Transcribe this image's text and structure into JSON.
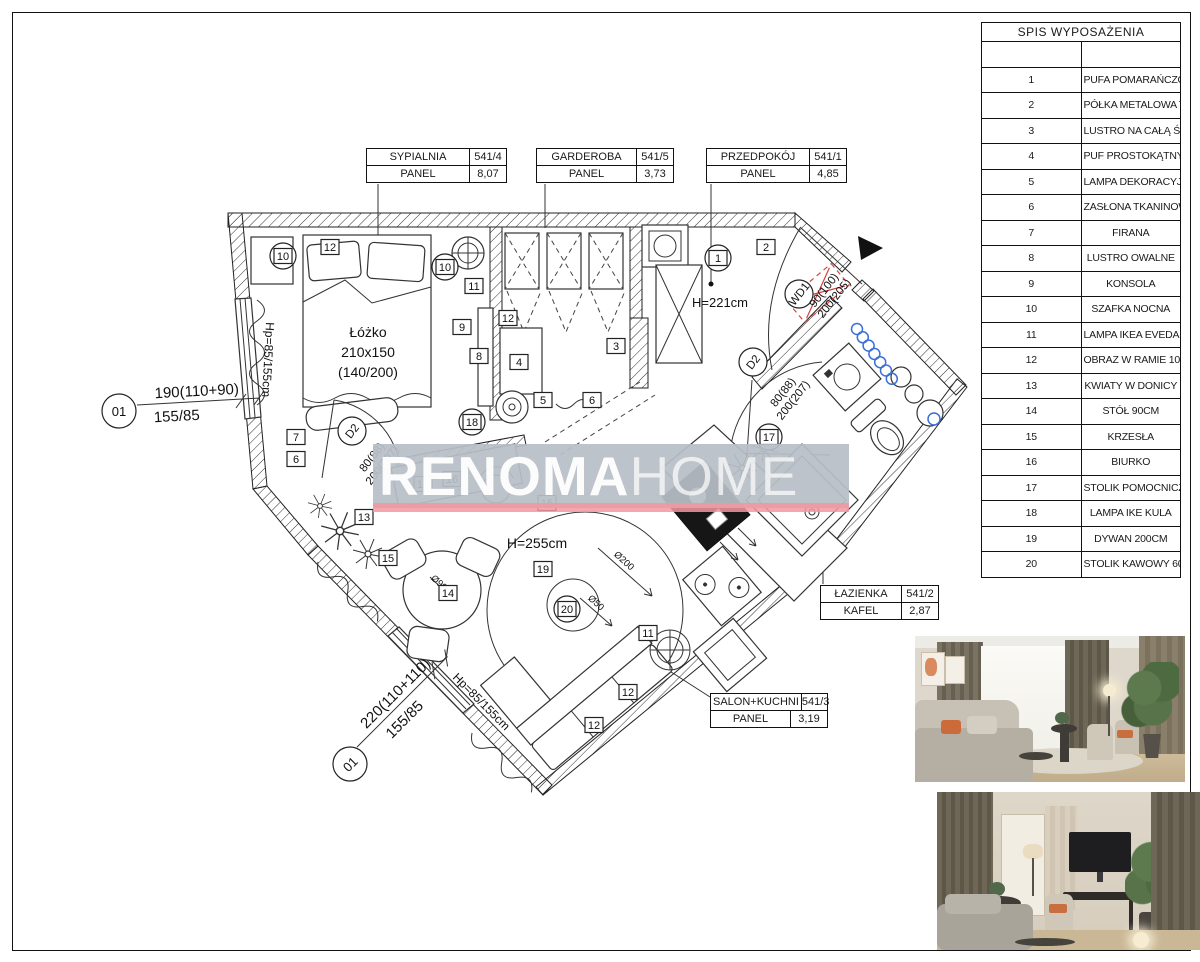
{
  "legend": {
    "title": "SPIS WYPOSAŻENIA",
    "items": [
      {
        "n": "1",
        "label": "PUFA POMARAŃCZOWA 40 CM"
      },
      {
        "n": "2",
        "label": "PÓŁKA METALOWA TRÓJĄTNA"
      },
      {
        "n": "3",
        "label": "LUSTRO NA CAŁĄ ŚCIANĘ"
      },
      {
        "n": "4",
        "label": "PUF PROSTOKĄTNY"
      },
      {
        "n": "5",
        "label": "LAMPA DEKORACYJNA IKEA ....."
      },
      {
        "n": "6",
        "label": "ZASŁONA TKANINOWA"
      },
      {
        "n": "7",
        "label": "FIRANA"
      },
      {
        "n": "8",
        "label": "LUSTRO OWALNE"
      },
      {
        "n": "9",
        "label": "KONSOLA"
      },
      {
        "n": "10",
        "label": "SZAFKA NOCNA"
      },
      {
        "n": "11",
        "label": "LAMPA IKEA EVEDAL"
      },
      {
        "n": "12",
        "label": "OBRAZ W RAMIE 100X70"
      },
      {
        "n": "13",
        "label": "KWIATY W DONICY"
      },
      {
        "n": "14",
        "label": "STÓŁ 90CM"
      },
      {
        "n": "15",
        "label": "KRZESŁA"
      },
      {
        "n": "16",
        "label": "BIURKO"
      },
      {
        "n": "17",
        "label": "STOLIK POMOCNICZY"
      },
      {
        "n": "18",
        "label": "LAMPA IKE KULA"
      },
      {
        "n": "19",
        "label": "DYWAN 200CM"
      },
      {
        "n": "20",
        "label": "STOLIK KAWOWY 60"
      }
    ]
  },
  "rooms": [
    {
      "name": "SYPIALNIA",
      "num": "541/4",
      "floor": "PANEL",
      "area": "8,07"
    },
    {
      "name": "GARDEROBA",
      "num": "541/5",
      "floor": "PANEL",
      "area": "3,73"
    },
    {
      "name": "PRZEDPOKÓJ",
      "num": "541/1",
      "floor": "PANEL",
      "area": "4,85"
    },
    {
      "name": "ŁAZIENKA",
      "num": "541/2",
      "floor": "KAFEL",
      "area": "2,87"
    },
    {
      "name": "SALON+KUCHNI",
      "num": "541/3",
      "floor": "PANEL",
      "area": "3,19"
    }
  ],
  "plan": {
    "bed": {
      "l1": "Łóżko",
      "l2": "210x150",
      "l3": "(140/200)"
    },
    "heights": {
      "hall": "H=221cm",
      "salon": "H=255cm",
      "parapet": "Hp=85/155cm"
    },
    "dims": {
      "win1": {
        "tag": "01",
        "top": "190(110+90)",
        "bottom": "155/85"
      },
      "win2": {
        "tag": "01",
        "top": "220(110+110)",
        "bottom": "155/85"
      },
      "door_int": {
        "tag": "D2",
        "w": "80(88)",
        "h": "200(207)"
      },
      "door_entry": {
        "tag": "WD1",
        "w": "90(100)",
        "h": "200(205)"
      }
    },
    "diameters": {
      "rug": "Ø200",
      "inner": "Ø50",
      "table": "Ø90"
    },
    "markers": [
      {
        "x": 283,
        "y": 256,
        "t": "10",
        "s": "cs"
      },
      {
        "x": 330,
        "y": 247,
        "t": "12",
        "s": "sq"
      },
      {
        "x": 445,
        "y": 267,
        "t": "10",
        "s": "cs"
      },
      {
        "x": 474,
        "y": 286,
        "t": "11",
        "s": "sq"
      },
      {
        "x": 462,
        "y": 327,
        "t": "9",
        "s": "sq"
      },
      {
        "x": 479,
        "y": 356,
        "t": "8",
        "s": "sq"
      },
      {
        "x": 296,
        "y": 437,
        "t": "7",
        "s": "sq"
      },
      {
        "x": 296,
        "y": 459,
        "t": "6",
        "s": "sq"
      },
      {
        "x": 508,
        "y": 318,
        "t": "12",
        "s": "sq"
      },
      {
        "x": 519,
        "y": 362,
        "t": "4",
        "s": "sq"
      },
      {
        "x": 543,
        "y": 400,
        "t": "5",
        "s": "sq"
      },
      {
        "x": 592,
        "y": 400,
        "t": "6",
        "s": "sq"
      },
      {
        "x": 616,
        "y": 346,
        "t": "3",
        "s": "sq"
      },
      {
        "x": 718,
        "y": 258,
        "t": "1",
        "s": "cs"
      },
      {
        "x": 766,
        "y": 247,
        "t": "2",
        "s": "sq"
      },
      {
        "x": 472,
        "y": 422,
        "t": "18",
        "s": "cs"
      },
      {
        "x": 423,
        "y": 484,
        "t": "18",
        "s": "sq"
      },
      {
        "x": 452,
        "y": 479,
        "t": "16",
        "s": "sq"
      },
      {
        "x": 364,
        "y": 517,
        "t": "13",
        "s": "sq"
      },
      {
        "x": 388,
        "y": 558,
        "t": "15",
        "s": "sq"
      },
      {
        "x": 448,
        "y": 593,
        "t": "14",
        "s": "sq"
      },
      {
        "x": 547,
        "y": 503,
        "t": "15",
        "s": "sq"
      },
      {
        "x": 543,
        "y": 569,
        "t": "19",
        "s": "sq"
      },
      {
        "x": 567,
        "y": 609,
        "t": "20",
        "s": "cs"
      },
      {
        "x": 648,
        "y": 633,
        "t": "11",
        "s": "sq"
      },
      {
        "x": 628,
        "y": 692,
        "t": "12",
        "s": "sq"
      },
      {
        "x": 594,
        "y": 725,
        "t": "12",
        "s": "sq"
      },
      {
        "x": 769,
        "y": 437,
        "t": "17",
        "s": "cs"
      }
    ]
  },
  "watermark": {
    "bold": "RENOMA",
    "light": "HOME"
  },
  "colors": {
    "accent_red": "#d84040",
    "radiator_blue": "#3a6fd8",
    "watermark_bg": "#b8bec6",
    "watermark_line": "#f396a0"
  }
}
